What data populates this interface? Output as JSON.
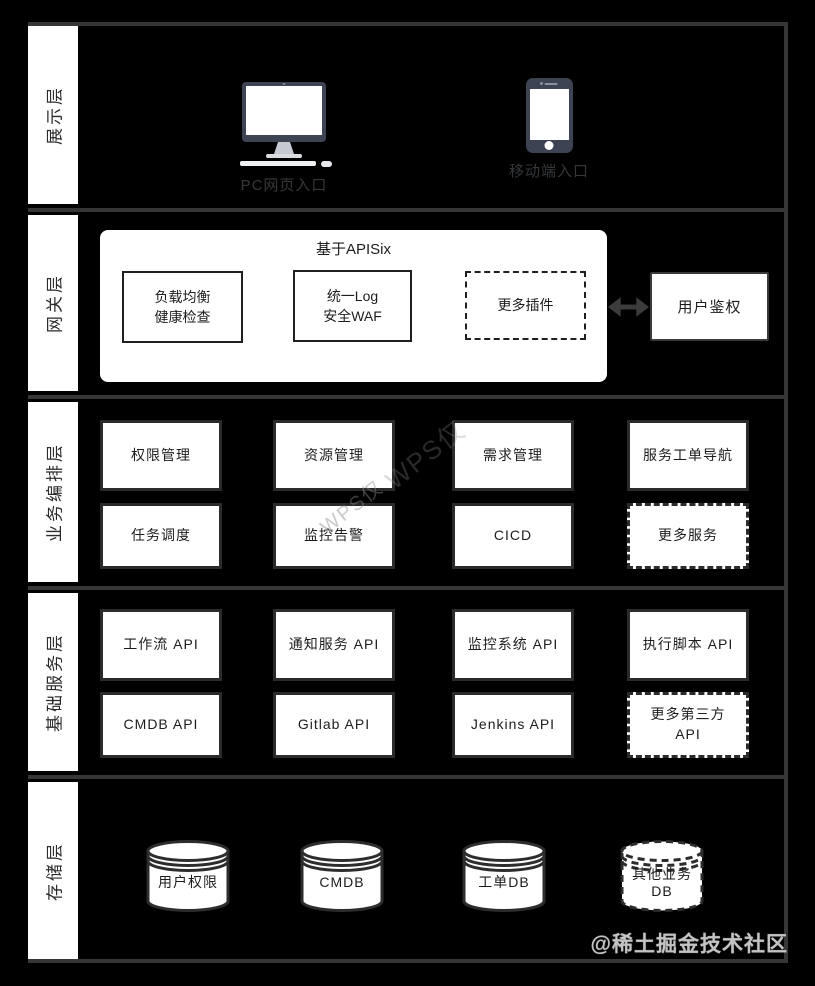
{
  "colors": {
    "background": "#000000",
    "panel": "#ffffff",
    "separator": "#363636",
    "box_border": "#2b2b2b",
    "device_body": "#3d4352"
  },
  "watermarks": {
    "wps": "WPS仅",
    "community": "@稀土掘金技术社区"
  },
  "layers": {
    "presentation": {
      "label": "展示层",
      "entries": [
        {
          "name": "pc",
          "label": "PC网页入口"
        },
        {
          "name": "mobile",
          "label": "移动端入口"
        }
      ]
    },
    "gateway": {
      "label": "网关层",
      "container_title": "基于APISix",
      "plugins": [
        "负载均衡\n健康检查",
        "统一Log\n安全WAF",
        "更多插件"
      ],
      "auth": "用户鉴权"
    },
    "orchestration": {
      "label": "业务编排层",
      "boxes": [
        "权限管理",
        "资源管理",
        "需求管理",
        "服务工单导航",
        "任务调度",
        "监控告警",
        "CICD",
        "更多服务"
      ]
    },
    "services": {
      "label": "基础服务层",
      "boxes": [
        "工作流 API",
        "通知服务 API",
        "监控系统 API",
        "执行脚本 API",
        "CMDB API",
        "Gitlab API",
        "Jenkins API",
        "更多第三方\nAPI"
      ]
    },
    "storage": {
      "label": "存储层",
      "dbs": [
        "用户权限",
        "CMDB",
        "工单DB",
        "其他业务\nDB"
      ]
    }
  }
}
